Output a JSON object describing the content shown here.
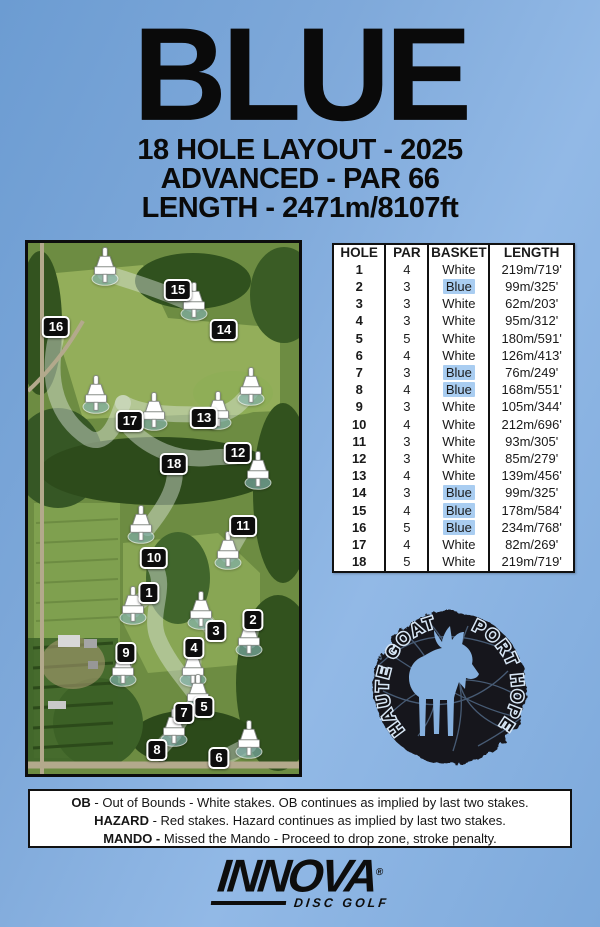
{
  "header": {
    "title": "BLUE",
    "subtitle1": "18 HOLE LAYOUT - 2025",
    "subtitle2": "ADVANCED - PAR 66",
    "subtitle3": "LENGTH - 2471m/8107ft"
  },
  "table": {
    "headers": [
      "HOLE",
      "PAR",
      "BASKET",
      "LENGTH"
    ],
    "rows": [
      {
        "hole": "1",
        "par": "4",
        "basket": "White",
        "length": "219m/719'"
      },
      {
        "hole": "2",
        "par": "3",
        "basket": "Blue",
        "length": "99m/325'"
      },
      {
        "hole": "3",
        "par": "3",
        "basket": "White",
        "length": "62m/203'"
      },
      {
        "hole": "4",
        "par": "3",
        "basket": "White",
        "length": "95m/312'"
      },
      {
        "hole": "5",
        "par": "5",
        "basket": "White",
        "length": "180m/591'"
      },
      {
        "hole": "6",
        "par": "4",
        "basket": "White",
        "length": "126m/413'"
      },
      {
        "hole": "7",
        "par": "3",
        "basket": "Blue",
        "length": "76m/249'"
      },
      {
        "hole": "8",
        "par": "4",
        "basket": "Blue",
        "length": "168m/551'"
      },
      {
        "hole": "9",
        "par": "3",
        "basket": "White",
        "length": "105m/344'"
      },
      {
        "hole": "10",
        "par": "4",
        "basket": "White",
        "length": "212m/696'"
      },
      {
        "hole": "11",
        "par": "3",
        "basket": "White",
        "length": "93m/305'"
      },
      {
        "hole": "12",
        "par": "3",
        "basket": "White",
        "length": "85m/279'"
      },
      {
        "hole": "13",
        "par": "4",
        "basket": "White",
        "length": "139m/456'"
      },
      {
        "hole": "14",
        "par": "3",
        "basket": "Blue",
        "length": "99m/325'"
      },
      {
        "hole": "15",
        "par": "4",
        "basket": "Blue",
        "length": "178m/584'"
      },
      {
        "hole": "16",
        "par": "5",
        "basket": "Blue",
        "length": "234m/768'"
      },
      {
        "hole": "17",
        "par": "4",
        "basket": "White",
        "length": "82m/269'"
      },
      {
        "hole": "18",
        "par": "5",
        "basket": "White",
        "length": "219m/719'"
      }
    ]
  },
  "map": {
    "baskets": [
      {
        "x": 77,
        "y": 27
      },
      {
        "x": 166,
        "y": 62
      },
      {
        "x": 68,
        "y": 155
      },
      {
        "x": 126,
        "y": 172
      },
      {
        "x": 190,
        "y": 171
      },
      {
        "x": 223,
        "y": 147
      },
      {
        "x": 230,
        "y": 231
      },
      {
        "x": 113,
        "y": 285
      },
      {
        "x": 200,
        "y": 311
      },
      {
        "x": 105,
        "y": 366
      },
      {
        "x": 173,
        "y": 371
      },
      {
        "x": 221,
        "y": 398
      },
      {
        "x": 95,
        "y": 428
      },
      {
        "x": 165,
        "y": 428
      },
      {
        "x": 170,
        "y": 454
      },
      {
        "x": 146,
        "y": 488
      },
      {
        "x": 221,
        "y": 500
      }
    ],
    "markers": [
      {
        "num": "16",
        "x": 28,
        "y": 84
      },
      {
        "num": "15",
        "x": 150,
        "y": 47
      },
      {
        "num": "14",
        "x": 196,
        "y": 87
      },
      {
        "num": "17",
        "x": 102,
        "y": 178
      },
      {
        "num": "13",
        "x": 176,
        "y": 175
      },
      {
        "num": "12",
        "x": 210,
        "y": 210
      },
      {
        "num": "18",
        "x": 146,
        "y": 221
      },
      {
        "num": "11",
        "x": 215,
        "y": 283
      },
      {
        "num": "10",
        "x": 126,
        "y": 315
      },
      {
        "num": "1",
        "x": 121,
        "y": 350
      },
      {
        "num": "2",
        "x": 225,
        "y": 377
      },
      {
        "num": "3",
        "x": 188,
        "y": 388
      },
      {
        "num": "4",
        "x": 166,
        "y": 405
      },
      {
        "num": "9",
        "x": 98,
        "y": 410
      },
      {
        "num": "5",
        "x": 176,
        "y": 464
      },
      {
        "num": "7",
        "x": 156,
        "y": 470
      },
      {
        "num": "8",
        "x": 129,
        "y": 507
      },
      {
        "num": "6",
        "x": 191,
        "y": 515
      }
    ]
  },
  "goat": {
    "text_left": "HAUTE GOAT",
    "text_right": "PORT HOPE"
  },
  "rules": {
    "ob_label": "OB",
    "ob_text": " - Out of Bounds - White stakes. OB continues as implied by last two stakes.",
    "hazard_label": "HAZARD",
    "hazard_text": " - Red stakes. Hazard continues as implied by last two stakes.",
    "mando_label": "MANDO -",
    "mando_text": " Missed the Mando - Proceed to drop zone, stroke penalty."
  },
  "brand": {
    "name": "INNOVA",
    "registered": "®",
    "tagline": "DISC GOLF"
  },
  "colors": {
    "highlight": "#a9cdf1",
    "marker-bg": "#0d0d0d",
    "poster-blue": "#7fa9da"
  }
}
